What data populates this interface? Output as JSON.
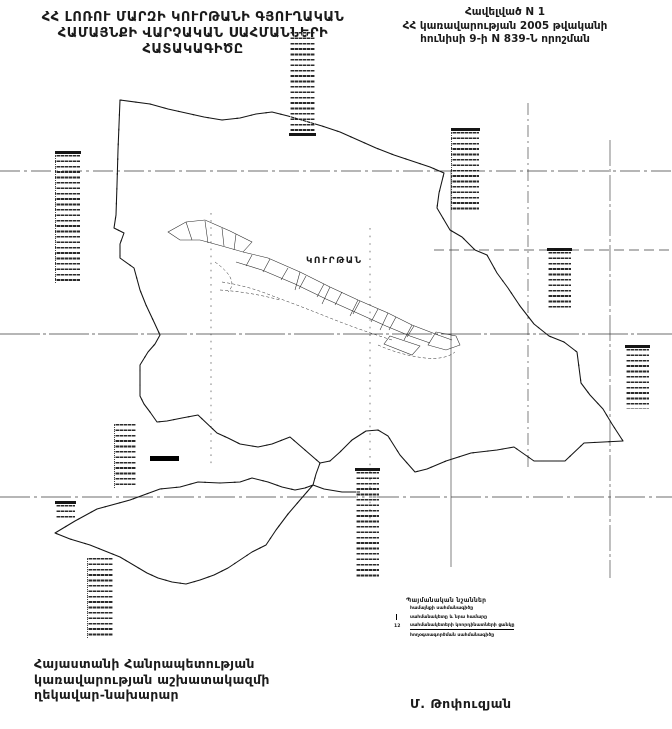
{
  "title": {
    "line1": "ՀՀ ԼՈՌՈՒ ՄԱՐԶԻ ԿՈՒՐԹԱՆԻ ԳՅՈՒՂԱԿԱՆ",
    "line2": "ՀԱՄԱՅՆՔԻ ՎԱՐՉԱԿԱՆ ՍԱՀՄԱՆՆԵՐԻ",
    "line3": "ՀԱՏԱԿԱԳԻԾԸ"
  },
  "appendix": {
    "line1": "Հավելված N 1",
    "line2": "ՀՀ կառավարության 2005 թվականի",
    "line3": "հունիսի 9-ի N 839-Ն որոշման"
  },
  "map": {
    "village_label": "ԿՈՒՐԹԱՆ"
  },
  "legend": {
    "title": "Պայմանական նշաններ",
    "items": [
      {
        "symbol": "double-dash-line",
        "label": "համայնքի սահմանագիծը"
      },
      {
        "symbol": "corner-tick",
        "label": "սահմանակետը և նրա համարը"
      },
      {
        "symbol": "point-number",
        "number": "12",
        "label": "սահմանակետերի կոորդինատների ցանկը"
      },
      {
        "symbol": "none",
        "label": "հողօգտագործման սահմանագիծը"
      }
    ]
  },
  "footer": {
    "line1": "Հայաստանի Հանրապետության",
    "line2": "կառավարության աշխատակազմի",
    "line3": "ղեկավար-նախարար",
    "signature": "Մ. Թոփուզյան"
  },
  "colors": {
    "ink": "#1b1b1b",
    "paper": "#ffffff"
  }
}
